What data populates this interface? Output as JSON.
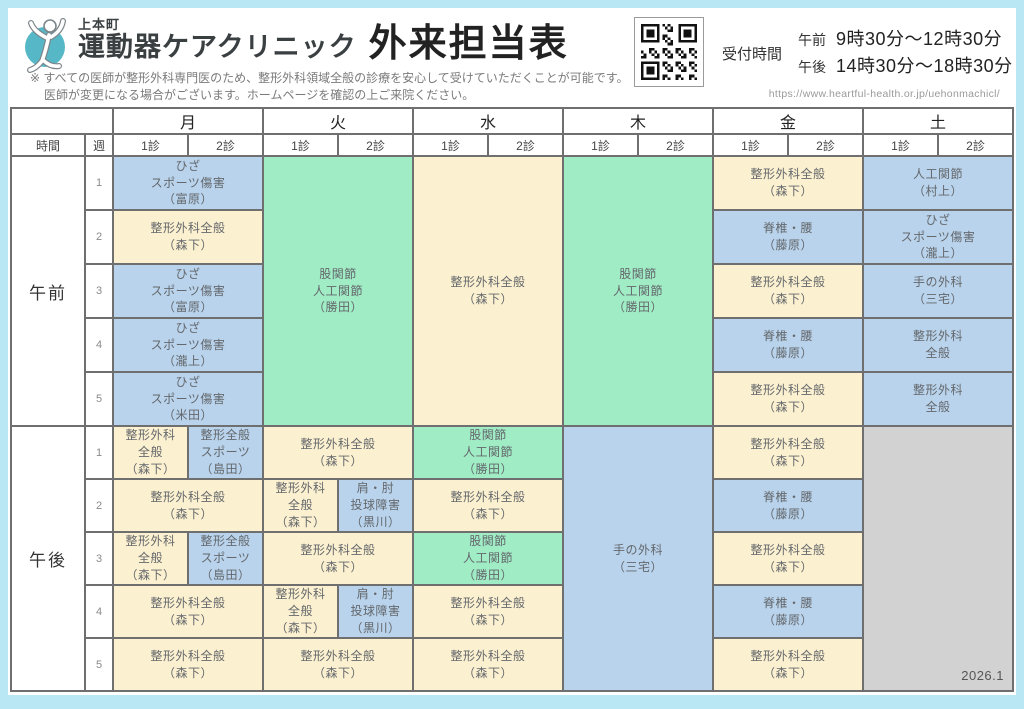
{
  "brand": {
    "area": "上本町",
    "name": "運動器ケアクリニック",
    "title": "外来担当表"
  },
  "note": {
    "line1": "※ すべての医師が整形外科専門医のため、整形外科領域全般の診療を安心して受けていただくことが可能です。",
    "line2": "医師が変更になる場合がございます。ホームページを確認の上ご来院ください。"
  },
  "reception": {
    "label": "受付時間",
    "am_label": "午前",
    "am_time": "9時30分～12時30分",
    "pm_label": "午後",
    "pm_time": "14時30分～18時30分"
  },
  "url": "https://www.heartful-health.or.jp/uehonmachicl/",
  "edition": "2026.1",
  "colors": {
    "blue": "#b8d3eb",
    "cream": "#fbf0cf",
    "green": "#a0ecc5",
    "grey": "#d2d2d2",
    "frame": "#b9e7f3",
    "border": "#6f6f6f",
    "accent_teal": "#56b7c6"
  },
  "table": {
    "corner_time": "時間",
    "corner_week": "週",
    "days": [
      "月",
      "火",
      "水",
      "木",
      "金",
      "土"
    ],
    "subcols": [
      "1診",
      "2診"
    ],
    "sessions": [
      {
        "label": "午前",
        "rows": [
          {
            "week": "1",
            "cells": [
              {
                "d": "mon",
                "cs": 2,
                "rs": 1,
                "color": "blue",
                "lines": [
                  "ひざ",
                  "スポーツ傷害",
                  "（富原）"
                ]
              },
              {
                "d": "tue",
                "cs": 2,
                "rs": 5,
                "color": "green",
                "lines": [
                  "股関節",
                  "人工関節",
                  "（勝田）"
                ]
              },
              {
                "d": "wed",
                "cs": 2,
                "rs": 5,
                "color": "cream",
                "lines": [
                  "整形外科全般",
                  "（森下）"
                ]
              },
              {
                "d": "thu",
                "cs": 2,
                "rs": 5,
                "color": "green",
                "lines": [
                  "股関節",
                  "人工関節",
                  "（勝田）"
                ]
              },
              {
                "d": "fri",
                "cs": 2,
                "rs": 1,
                "color": "cream",
                "lines": [
                  "整形外科全般",
                  "（森下）"
                ]
              },
              {
                "d": "sat",
                "cs": 2,
                "rs": 1,
                "color": "blue",
                "lines": [
                  "人工関節",
                  "（村上）"
                ]
              }
            ]
          },
          {
            "week": "2",
            "cells": [
              {
                "d": "mon",
                "cs": 2,
                "rs": 1,
                "color": "cream",
                "lines": [
                  "整形外科全般",
                  "（森下）"
                ]
              },
              {
                "d": "fri",
                "cs": 2,
                "rs": 1,
                "color": "blue",
                "lines": [
                  "脊椎・腰",
                  "（藤原）"
                ]
              },
              {
                "d": "sat",
                "cs": 2,
                "rs": 1,
                "color": "blue",
                "lines": [
                  "ひざ",
                  "スポーツ傷害",
                  "（瀧上）"
                ]
              }
            ]
          },
          {
            "week": "3",
            "cells": [
              {
                "d": "mon",
                "cs": 2,
                "rs": 1,
                "color": "blue",
                "lines": [
                  "ひざ",
                  "スポーツ傷害",
                  "（富原）"
                ]
              },
              {
                "d": "fri",
                "cs": 2,
                "rs": 1,
                "color": "cream",
                "lines": [
                  "整形外科全般",
                  "（森下）"
                ]
              },
              {
                "d": "sat",
                "cs": 2,
                "rs": 1,
                "color": "blue",
                "lines": [
                  "手の外科",
                  "（三宅）"
                ]
              }
            ]
          },
          {
            "week": "4",
            "cells": [
              {
                "d": "mon",
                "cs": 2,
                "rs": 1,
                "color": "blue",
                "lines": [
                  "ひざ",
                  "スポーツ傷害",
                  "（瀧上）"
                ]
              },
              {
                "d": "fri",
                "cs": 2,
                "rs": 1,
                "color": "blue",
                "lines": [
                  "脊椎・腰",
                  "（藤原）"
                ]
              },
              {
                "d": "sat",
                "cs": 2,
                "rs": 1,
                "color": "blue",
                "lines": [
                  "整形外科",
                  "全般"
                ]
              }
            ]
          },
          {
            "week": "5",
            "cells": [
              {
                "d": "mon",
                "cs": 2,
                "rs": 1,
                "color": "blue",
                "lines": [
                  "ひざ",
                  "スポーツ傷害",
                  "（米田）"
                ]
              },
              {
                "d": "fri",
                "cs": 2,
                "rs": 1,
                "color": "cream",
                "lines": [
                  "整形外科全般",
                  "（森下）"
                ]
              },
              {
                "d": "sat",
                "cs": 2,
                "rs": 1,
                "color": "blue",
                "lines": [
                  "整形外科",
                  "全般"
                ]
              }
            ]
          }
        ]
      },
      {
        "label": "午後",
        "rows": [
          {
            "week": "1",
            "cells": [
              {
                "d": "mon-1",
                "cs": 1,
                "rs": 1,
                "color": "cream",
                "lines": [
                  "整形外科",
                  "全般",
                  "（森下）"
                ]
              },
              {
                "d": "mon-2",
                "cs": 1,
                "rs": 1,
                "color": "blue",
                "lines": [
                  "整形全般",
                  "スポーツ",
                  "（島田）"
                ]
              },
              {
                "d": "tue",
                "cs": 2,
                "rs": 1,
                "color": "cream",
                "lines": [
                  "整形外科全般",
                  "（森下）"
                ]
              },
              {
                "d": "wed",
                "cs": 2,
                "rs": 1,
                "color": "green",
                "lines": [
                  "股関節",
                  "人工関節",
                  "（勝田）"
                ]
              },
              {
                "d": "thu",
                "cs": 2,
                "rs": 5,
                "color": "blue",
                "lines": [
                  "手の外科",
                  "（三宅）"
                ]
              },
              {
                "d": "fri",
                "cs": 2,
                "rs": 1,
                "color": "cream",
                "lines": [
                  "整形外科全般",
                  "（森下）"
                ]
              },
              {
                "d": "sat",
                "cs": 2,
                "rs": 5,
                "color": "grey",
                "lines": [],
                "corner": "2026.1"
              }
            ]
          },
          {
            "week": "2",
            "cells": [
              {
                "d": "mon",
                "cs": 2,
                "rs": 1,
                "color": "cream",
                "lines": [
                  "整形外科全般",
                  "（森下）"
                ]
              },
              {
                "d": "tue-1",
                "cs": 1,
                "rs": 1,
                "color": "cream",
                "lines": [
                  "整形外科",
                  "全般",
                  "（森下）"
                ]
              },
              {
                "d": "tue-2",
                "cs": 1,
                "rs": 1,
                "color": "blue",
                "lines": [
                  "肩・肘",
                  "投球障害",
                  "（黒川）"
                ]
              },
              {
                "d": "wed",
                "cs": 2,
                "rs": 1,
                "color": "cream",
                "lines": [
                  "整形外科全般",
                  "（森下）"
                ]
              },
              {
                "d": "fri",
                "cs": 2,
                "rs": 1,
                "color": "blue",
                "lines": [
                  "脊椎・腰",
                  "（藤原）"
                ]
              }
            ]
          },
          {
            "week": "3",
            "cells": [
              {
                "d": "mon-1",
                "cs": 1,
                "rs": 1,
                "color": "cream",
                "lines": [
                  "整形外科",
                  "全般",
                  "（森下）"
                ]
              },
              {
                "d": "mon-2",
                "cs": 1,
                "rs": 1,
                "color": "blue",
                "lines": [
                  "整形全般",
                  "スポーツ",
                  "（島田）"
                ]
              },
              {
                "d": "tue",
                "cs": 2,
                "rs": 1,
                "color": "cream",
                "lines": [
                  "整形外科全般",
                  "（森下）"
                ]
              },
              {
                "d": "wed",
                "cs": 2,
                "rs": 1,
                "color": "green",
                "lines": [
                  "股関節",
                  "人工関節",
                  "（勝田）"
                ]
              },
              {
                "d": "fri",
                "cs": 2,
                "rs": 1,
                "color": "cream",
                "lines": [
                  "整形外科全般",
                  "（森下）"
                ]
              }
            ]
          },
          {
            "week": "4",
            "cells": [
              {
                "d": "mon",
                "cs": 2,
                "rs": 1,
                "color": "cream",
                "lines": [
                  "整形外科全般",
                  "（森下）"
                ]
              },
              {
                "d": "tue-1",
                "cs": 1,
                "rs": 1,
                "color": "cream",
                "lines": [
                  "整形外科",
                  "全般",
                  "（森下）"
                ]
              },
              {
                "d": "tue-2",
                "cs": 1,
                "rs": 1,
                "color": "blue",
                "lines": [
                  "肩・肘",
                  "投球障害",
                  "（黒川）"
                ]
              },
              {
                "d": "wed",
                "cs": 2,
                "rs": 1,
                "color": "cream",
                "lines": [
                  "整形外科全般",
                  "（森下）"
                ]
              },
              {
                "d": "fri",
                "cs": 2,
                "rs": 1,
                "color": "blue",
                "lines": [
                  "脊椎・腰",
                  "（藤原）"
                ]
              }
            ]
          },
          {
            "week": "5",
            "cells": [
              {
                "d": "mon",
                "cs": 2,
                "rs": 1,
                "color": "cream",
                "lines": [
                  "整形外科全般",
                  "（森下）"
                ]
              },
              {
                "d": "tue",
                "cs": 2,
                "rs": 1,
                "color": "cream",
                "lines": [
                  "整形外科全般",
                  "（森下）"
                ]
              },
              {
                "d": "wed",
                "cs": 2,
                "rs": 1,
                "color": "cream",
                "lines": [
                  "整形外科全般",
                  "（森下）"
                ]
              },
              {
                "d": "fri",
                "cs": 2,
                "rs": 1,
                "color": "cream",
                "lines": [
                  "整形外科全般",
                  "（森下）"
                ]
              }
            ]
          }
        ]
      }
    ]
  }
}
